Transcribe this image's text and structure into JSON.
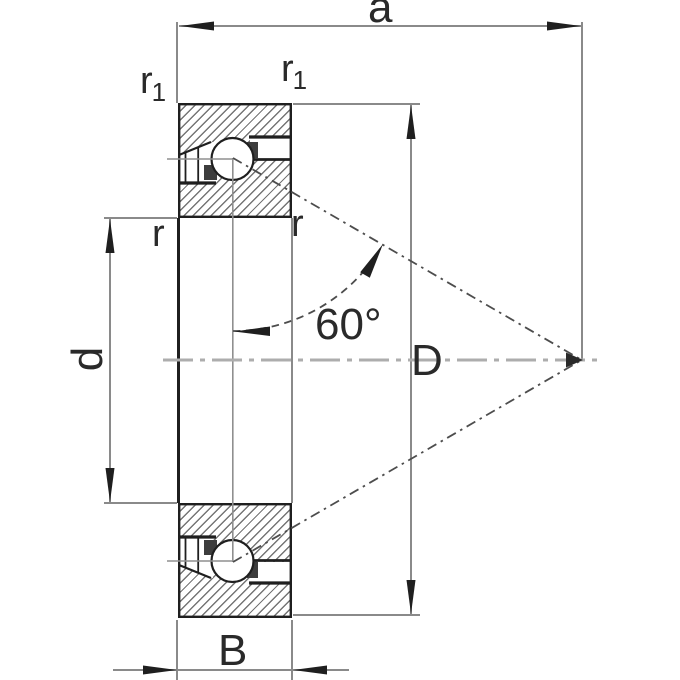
{
  "diagram": {
    "title": "axial angular contact ball bearing section drawing",
    "labels": {
      "dim_a": "a",
      "dim_d": "d",
      "dim_D": "D",
      "dim_B": "B",
      "radius_r": "r",
      "radius_r1_base": "r",
      "radius_r1_sub": "1",
      "contact_angle": "60°"
    },
    "colors": {
      "outline": "#1f1f1f",
      "dimension_lines": "#8a8a8a",
      "centerline": "#adadad",
      "contact_line": "#4d4d4d",
      "hatch": "#757575",
      "background": "#ffffff",
      "text": "#2a2a2a"
    }
  }
}
